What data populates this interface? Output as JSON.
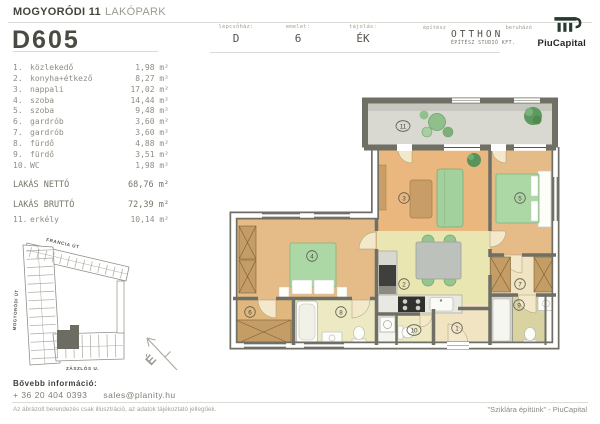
{
  "header": {
    "project_title_bold": "MOGYORÓDI 11",
    "project_title_light": "LAKÓPARK",
    "unit_id": "D605",
    "meta": [
      {
        "label": "lépcsőház:",
        "value": "D"
      },
      {
        "label": "emelet:",
        "value": "6"
      },
      {
        "label": "tájolás:",
        "value": "ÉK"
      }
    ],
    "architect": {
      "label": "építész",
      "name": "OTTHON",
      "subtitle": "ÉPÍTÉSZ STUDIÓ KFT."
    },
    "developer": {
      "label": "beruházó",
      "name": "PiuCapital"
    }
  },
  "room_list": {
    "rooms": [
      {
        "num": "1.",
        "name": "közlekedő",
        "area": "1,98 m²"
      },
      {
        "num": "2.",
        "name": "konyha+étkező",
        "area": "8,27 m²"
      },
      {
        "num": "3.",
        "name": "nappali",
        "area": "17,02 m²"
      },
      {
        "num": "4.",
        "name": "szoba",
        "area": "14,44 m²"
      },
      {
        "num": "5.",
        "name": "szoba",
        "area": "9,48 m²"
      },
      {
        "num": "6.",
        "name": "gardrób",
        "area": "3,60 m²"
      },
      {
        "num": "7.",
        "name": "gardrób",
        "area": "3,60 m²"
      },
      {
        "num": "8.",
        "name": "fürdő",
        "area": "4,88 m²"
      },
      {
        "num": "9.",
        "name": "fürdő",
        "area": "3,51 m²"
      },
      {
        "num": "10.",
        "name": "WC",
        "area": "1,98 m²"
      }
    ],
    "totals": [
      {
        "label": "LAKÁS NETTÓ",
        "value": "68,76 m²"
      },
      {
        "label": "LAKÁS BRUTTÓ",
        "value": "72,39 m²"
      }
    ],
    "balcony": {
      "num": "11.",
      "name": "erkély",
      "area": "10,14 m²"
    }
  },
  "site_map": {
    "street_top": "FRANCIA ÚT",
    "street_left": "MOGYORÓDI ÚT",
    "street_bottom": "ZÁSZLÓS U.",
    "north_label": "É"
  },
  "floorplan": {
    "labels": {
      "r1": "1",
      "r2": "2",
      "r3": "3",
      "r4": "4",
      "r5": "5",
      "r6": "6",
      "r7": "7",
      "r8": "8",
      "r9": "9",
      "r10": "10",
      "r11": "11"
    }
  },
  "footer": {
    "info_label": "Bővebb információ:",
    "phone": "+ 36 20 404 0393",
    "email": "sales@planity.hu",
    "disclaimer": "Az ábrázolt berendezés csak illusztráció, az adatok tájékoztató jellegűek.",
    "slogan": "\"Sziklára építünk\" - PiuCapital"
  },
  "colors": {
    "wall": "#6f6f66",
    "highlighted_unit": "#6c6c62",
    "accent_green": "#a8d6a2"
  }
}
